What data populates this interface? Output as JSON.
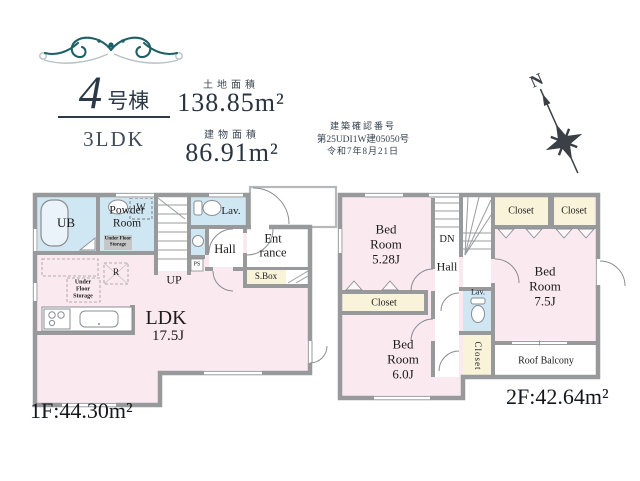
{
  "palette": {
    "wall_gray": "#97999b",
    "room_pink": "#faeaf0",
    "wet_area_blue": "#cfe6f3",
    "closet_cream": "#f8f3d9",
    "accent_teal": "#1e5f66",
    "header_text": "#35424e"
  },
  "header": {
    "building_number": "4",
    "building_suffix": "号棟",
    "plan_type": "3LDK",
    "land_area_label": "土地面積",
    "land_area_value": "138.85m²",
    "building_area_label": "建物面積",
    "building_area_value": "86.91m²",
    "approval_label": "建築確認番号",
    "approval_number": "第25UDI1W建05050号",
    "approval_date": "令和7年8月21日",
    "compass_north": "N"
  },
  "floor1": {
    "floor_area": "1F:44.30m²",
    "ub": "UB",
    "powder_line1": "Powder",
    "powder_line2": "Room",
    "washer": "W",
    "ufs_powder_line1": "Under Floor",
    "ufs_powder_line2": "Storage",
    "lav": "Lav.",
    "hall": "Hall",
    "entrance_line1": "Ent",
    "entrance_line2": "rance",
    "shoe_box": "S.Box",
    "pipe_space": "PS",
    "stairs_up": "UP",
    "refrigerator": "R",
    "ufs_line1": "Under",
    "ufs_line2": "Floor",
    "ufs_line3": "Storage",
    "ldk_name": "LDK",
    "ldk_size": "17.5J"
  },
  "floor2": {
    "floor_area": "2F:42.64m²",
    "bedroom1_line1": "Bed",
    "bedroom1_line2": "Room",
    "bedroom1_size": "5.28J",
    "bedroom2_line1": "Bed",
    "bedroom2_line2": "Room",
    "bedroom2_size": "7.5J",
    "bedroom3_line1": "Bed",
    "bedroom3_line2": "Room",
    "bedroom3_size": "6.0J",
    "closet_left": "Closet",
    "closet_top1": "Closet",
    "closet_top2": "Closet",
    "closet_mid": "Closet",
    "stairs_down": "DN",
    "hall": "Hall",
    "lav": "Lav.",
    "roof_balcony": "Roof Balcony"
  }
}
